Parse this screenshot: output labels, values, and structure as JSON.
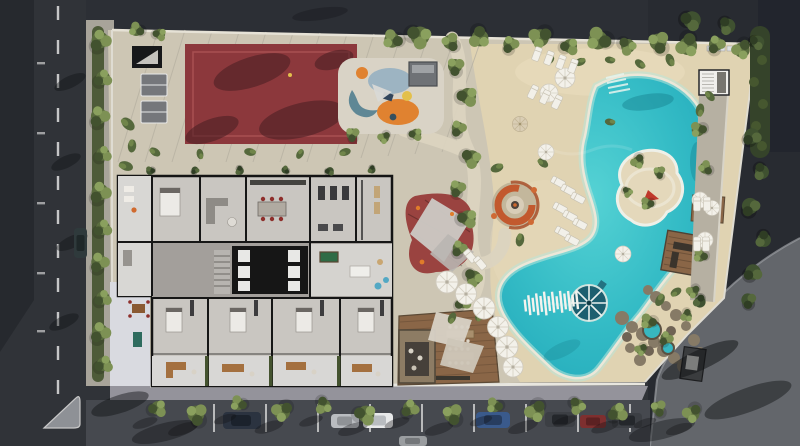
{
  "meta": {
    "title": "Aerial rendering of residential development site plan",
    "view": "top-down drone view, daytime",
    "visible_text": ""
  },
  "palette": {
    "road_dark": "#303338",
    "road_top": "#2c2f35",
    "road_right": "#282b31",
    "road_right_band": "#22252d",
    "road_light": "#63666b",
    "road_bottom": "#46494f",
    "plaza": "#26292e",
    "sidewalk": "#94939b",
    "walk_white": "#d9dae0",
    "deck": "#cdc6b4",
    "sand": "#e0d3b2",
    "sand_hot": "#ecdfc0",
    "path": "#dcd4c0",
    "court_red": "#8c383c",
    "court_line": "#a85052",
    "mat_red": "#9a4340",
    "pool_main": "#3bc3c9",
    "pool_deep": "#21a9ba",
    "pool_shallow": "#b9e6db",
    "pool_rim": "#ece7d8",
    "pool_shadow": "#17808e",
    "island_sand": "#e4d8bb",
    "wheel_blue": "#1d5f6f",
    "wood": "#8a6647",
    "wood_dark": "#5c4a36",
    "stone": "#8d7c64",
    "canvas_white": "#f3f1ea",
    "umbrella_tan": "#d9cdb4",
    "tree_green": "#5a6c3e",
    "tree_green_light": "#7d9154",
    "tree_green_dark": "#42522f",
    "tree_top": "#8aa05e",
    "hedge": "#44532f",
    "building_floor": "#c9c6c1",
    "building_patio": "#d8d7d4",
    "wall_black": "#161616",
    "corridor": "#a39f9b",
    "stairs": "#b7b4b0",
    "fire_ring": "#c2592e",
    "terracotta": "#a8502c",
    "accent_orange": "#e08230",
    "accent_teal": "#5f8795",
    "accent_lightblue": "#9db4c2",
    "accent_yellow": "#e3c04b",
    "accent_navy": "#31455c",
    "tent_red": "#c0392b",
    "rock": "#867a66",
    "car_navy": "#2b3340",
    "car_silver": "#b9bcc0",
    "car_white": "#e8e9ea",
    "car_blue": "#3a5a8c",
    "car_red": "#7e2f2f",
    "car_charcoal": "#3c3f44",
    "car_teal": "#2f3a3c",
    "marking_white": "#e0e0e0"
  },
  "scene": {
    "amenities": [
      "tennis-court",
      "table-tennis-tables",
      "children-playground",
      "shade-sail-play-mat",
      "fire-pit-lounge",
      "lagoon-pool",
      "pool-island",
      "round-water-feature",
      "white-plank-bridge",
      "sand-beach-with-loungers",
      "wooden-dining-deck",
      "pool-cabana",
      "rock-grotto-spa",
      "residential-building-floorplan",
      "street-parking",
      "perimeter-roads"
    ],
    "counts": {
      "white-umbrellas": 14,
      "parked-cars": 9
    }
  }
}
